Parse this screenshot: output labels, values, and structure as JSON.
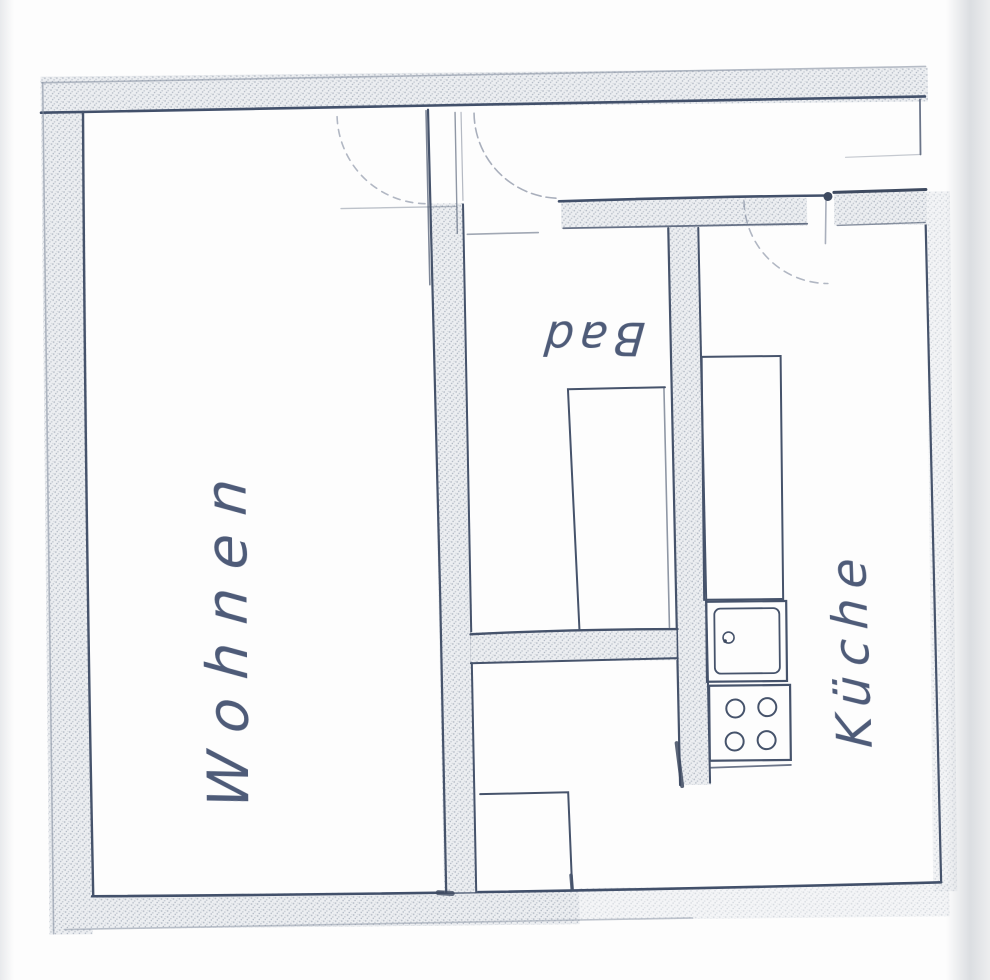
{
  "floorplan": {
    "rooms": [
      {
        "key": "wohnen",
        "label": "Wohnen"
      },
      {
        "key": "bad",
        "label": "Bad"
      },
      {
        "key": "kueche",
        "label": "Küche"
      }
    ],
    "colors": {
      "ink": "#46536b",
      "wall_fill": "#eceef1",
      "paper": "#fdfdfd"
    },
    "fixtures": [
      {
        "name": "bathtub"
      },
      {
        "name": "kitchen-counter"
      },
      {
        "name": "kitchen-sink"
      },
      {
        "name": "stove-four-burners"
      }
    ],
    "doors": [
      {
        "name": "entry-door-swing-left"
      },
      {
        "name": "entry-door-swing-right"
      },
      {
        "name": "kitchen-door-swing"
      }
    ]
  }
}
